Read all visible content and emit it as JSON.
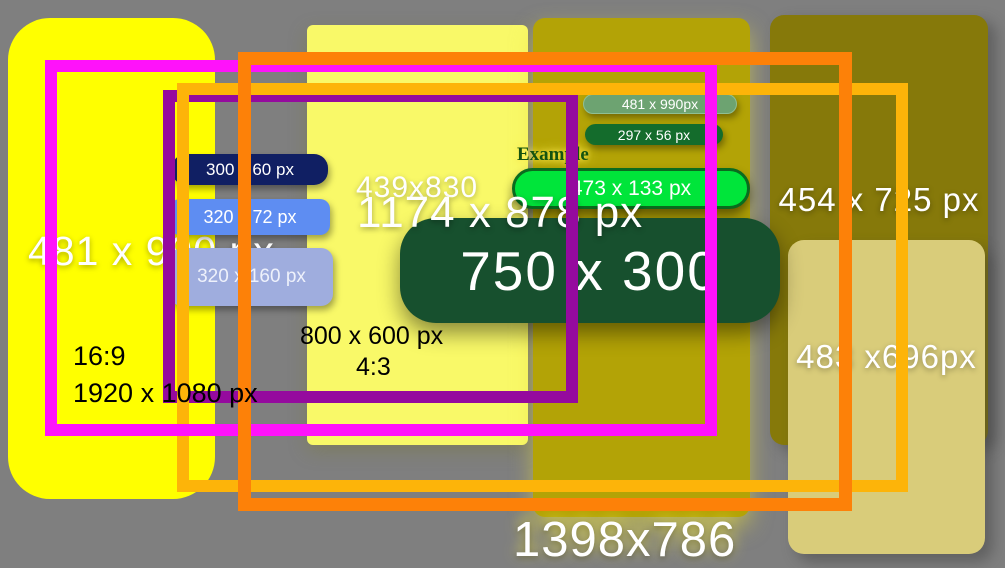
{
  "background_color": "#7f7f7f",
  "panels": {
    "yellow_left": {
      "label": "481 x 990 px",
      "fill": "#ffff00"
    },
    "light_yellow": {
      "label": "439x830",
      "fill": "#f9f968"
    },
    "olive_middle": {
      "label": "1398x786",
      "fill": "#b3a306"
    },
    "olive_right": {
      "label": "454 x 725 px",
      "fill": "#86790a"
    },
    "khaki_right": {
      "label": "483 x696px",
      "fill": "#d9cc7a"
    }
  },
  "annotations": {
    "aspect_16_9": "16:9",
    "res_1920_1080": "1920 x 1080 px",
    "res_800_600": "800 x 600 px",
    "aspect_4_3": "4:3",
    "overlay_dimension": "1174 x 878 px"
  },
  "banner": {
    "label": "750 x 300",
    "fill": "#17502e"
  },
  "blue_buttons": [
    {
      "label": "300 x 60 px",
      "fill": "#101f63"
    },
    {
      "label": "320 x 72 px",
      "fill": "#5e8df2"
    },
    {
      "label": "320 x 160 px",
      "fill": "#9fadde"
    }
  ],
  "green_buttons": [
    {
      "label": "481 x 990px",
      "fill": "#6da371"
    },
    {
      "label": "297 x 56 px",
      "fill": "#146c2c"
    },
    {
      "label": "473 x 133 px",
      "fill": "#00e53a"
    }
  ],
  "example_heading": "Example",
  "outline_frames": {
    "magenta": "#ff12fa",
    "purple": "#950a9e",
    "orange": "#fd8108",
    "amber": "#fdb409"
  }
}
